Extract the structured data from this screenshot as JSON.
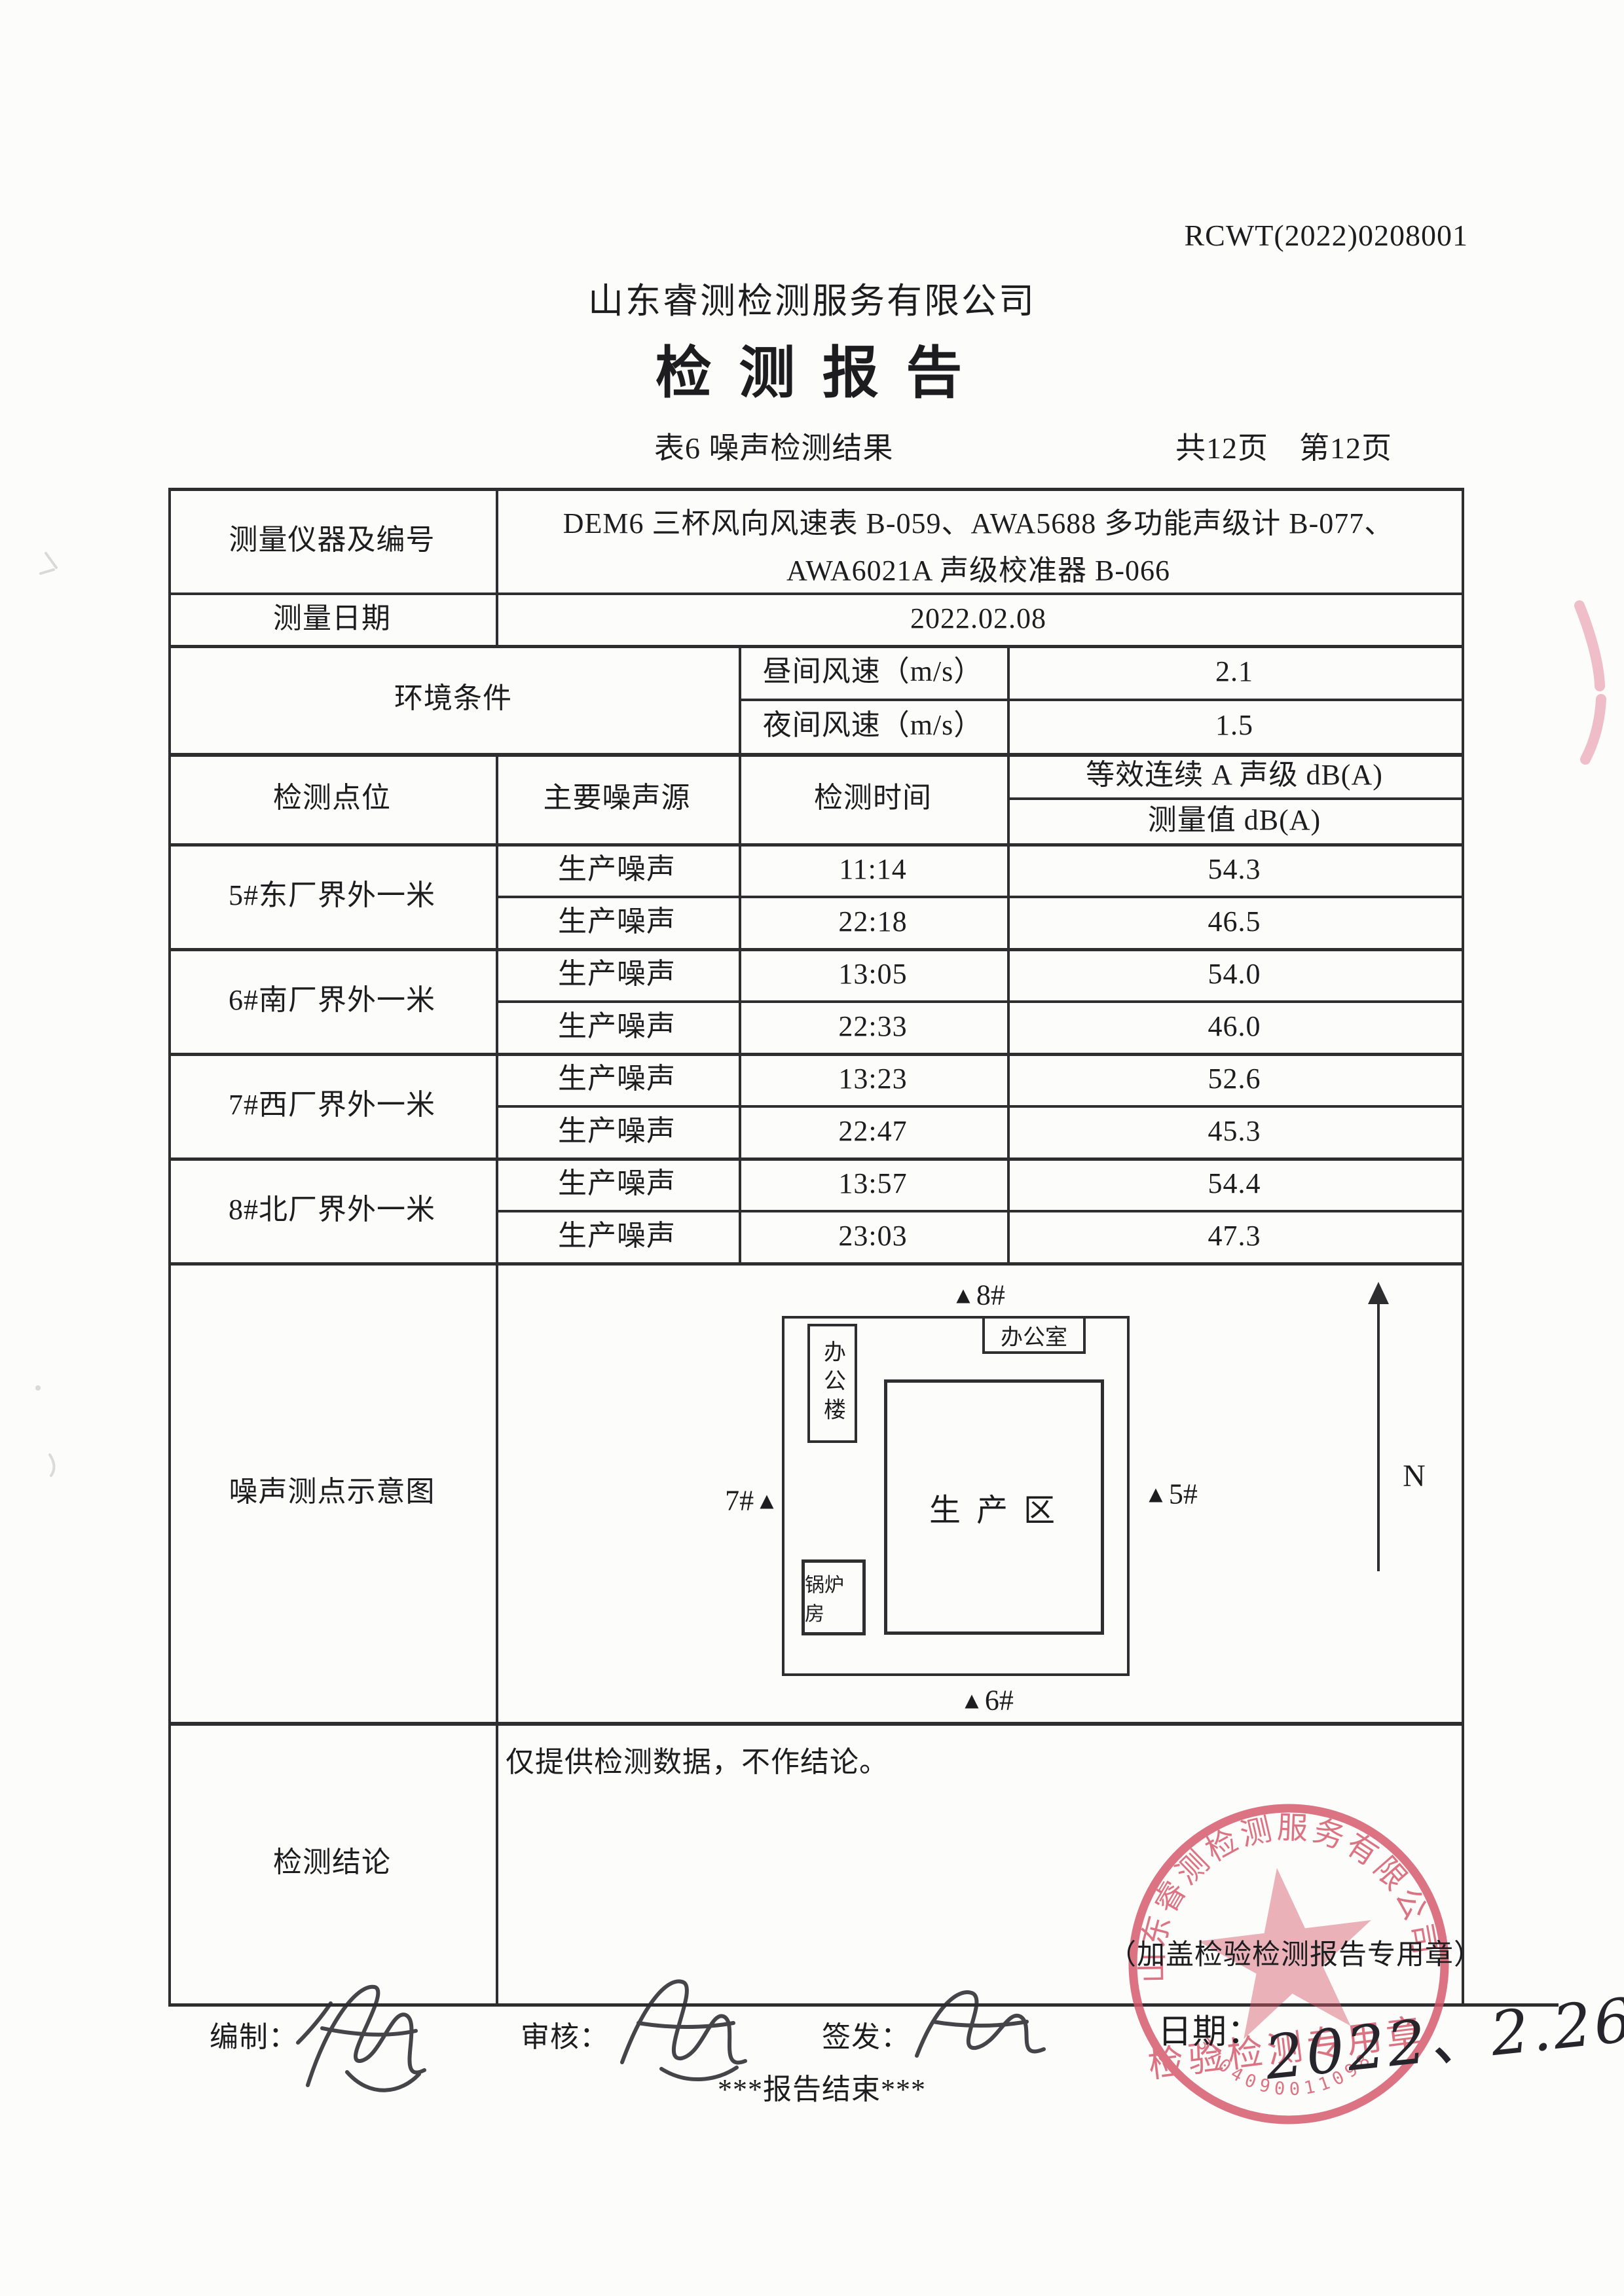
{
  "page": {
    "report_no": "RCWT(2022)0208001",
    "company": "山东睿测检测服务有限公司",
    "title": "检 测 报 告",
    "caption": "表6 噪声检测结果",
    "pages": "共12页　第12页"
  },
  "info": {
    "instrument_label": "测量仪器及编号",
    "instrument_line1": "DEM6 三杯风向风速表 B-059、AWA5688 多功能声级计 B-077、",
    "instrument_line2": "AWA6021A 声级校准器 B-066",
    "date_label": "测量日期",
    "date_value": "2022.02.08",
    "env_label": "环境条件",
    "day_label": "昼间风速（m/s）",
    "day_value": "2.1",
    "night_label": "夜间风速（m/s）",
    "night_value": "1.5"
  },
  "results": {
    "col_point": "检测点位",
    "col_source": "主要噪声源",
    "col_time": "检测时间",
    "col_level": "等效连续 A 声级 dB(A)",
    "col_value": "测量值 dB(A)",
    "rows": [
      {
        "point": "5#东厂界外一米",
        "entries": [
          {
            "source": "生产噪声",
            "time": "11:14",
            "value": "54.3"
          },
          {
            "source": "生产噪声",
            "time": "22:18",
            "value": "46.5"
          }
        ]
      },
      {
        "point": "6#南厂界外一米",
        "entries": [
          {
            "source": "生产噪声",
            "time": "13:05",
            "value": "54.0"
          },
          {
            "source": "生产噪声",
            "time": "22:33",
            "value": "46.0"
          }
        ]
      },
      {
        "point": "7#西厂界外一米",
        "entries": [
          {
            "source": "生产噪声",
            "time": "13:23",
            "value": "52.6"
          },
          {
            "source": "生产噪声",
            "time": "22:47",
            "value": "45.3"
          }
        ]
      },
      {
        "point": "8#北厂界外一米",
        "entries": [
          {
            "source": "生产噪声",
            "time": "13:57",
            "value": "54.4"
          },
          {
            "source": "生产噪声",
            "time": "23:03",
            "value": "47.3"
          }
        ]
      }
    ]
  },
  "diagram": {
    "label": "噪声测点示意图",
    "north": "N",
    "triangle": "▲",
    "production_area": "生  产  区",
    "office_building": "办公楼",
    "office_room": "办公室",
    "boiler_room": "锅炉房",
    "marker5": "5#",
    "marker6": "6#",
    "marker7": "7#",
    "marker8": "8#"
  },
  "conclusion": {
    "label": "检测结论",
    "text": "仅提供检测数据，不作结论。",
    "seal_note": "（加盖检验检测报告专用章）"
  },
  "footer": {
    "prepared_label": "编制：",
    "reviewed_label": "审核：",
    "issued_label": "签发：",
    "date_label": "日期：",
    "date_value": "2022、2.26",
    "end_text": "***报告结束***"
  },
  "stamp": {
    "arc_text": "山东睿测检测服务有限公司",
    "center_text": "检验检测专用章",
    "code": "3704090011098",
    "color": "#d6556a"
  }
}
